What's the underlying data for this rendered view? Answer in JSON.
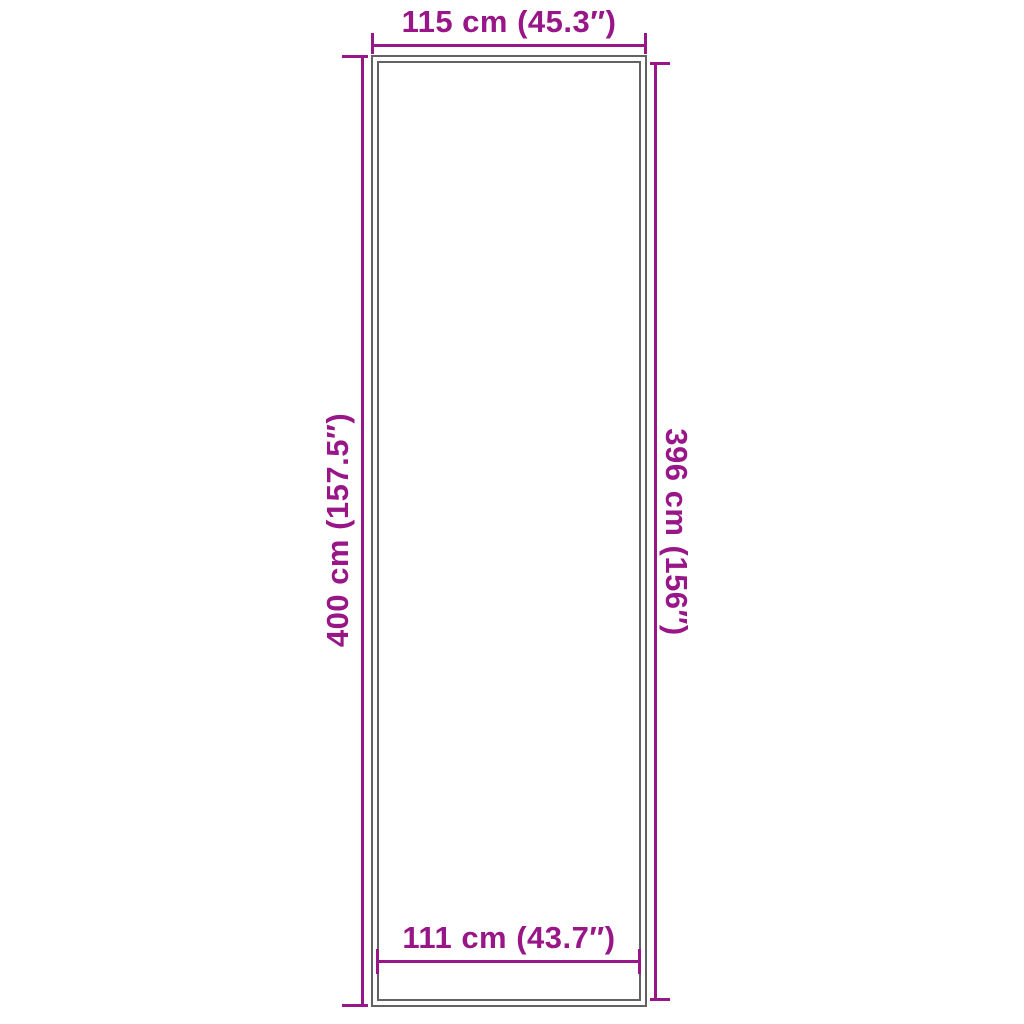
{
  "diagram": {
    "kind": "product-dimension-diagram",
    "object": "tall rectangular mat / runner outline with double border",
    "colors": {
      "dimension": "#981687",
      "outline": "#626262",
      "background": "#ffffff"
    },
    "dimensions": {
      "top": {
        "side": "top",
        "value_cm": 115,
        "value_in": 45.3,
        "label": "115 cm (45.3″)"
      },
      "bottom": {
        "side": "bottom",
        "value_cm": 111,
        "value_in": 43.7,
        "label": "111 cm (43.7″)"
      },
      "left": {
        "side": "left",
        "value_cm": 400,
        "value_in": 157.5,
        "label": "400 cm (157.5″)"
      },
      "right": {
        "side": "right",
        "value_cm": 396,
        "value_in": 156,
        "label": "396 cm (156″)"
      }
    }
  }
}
